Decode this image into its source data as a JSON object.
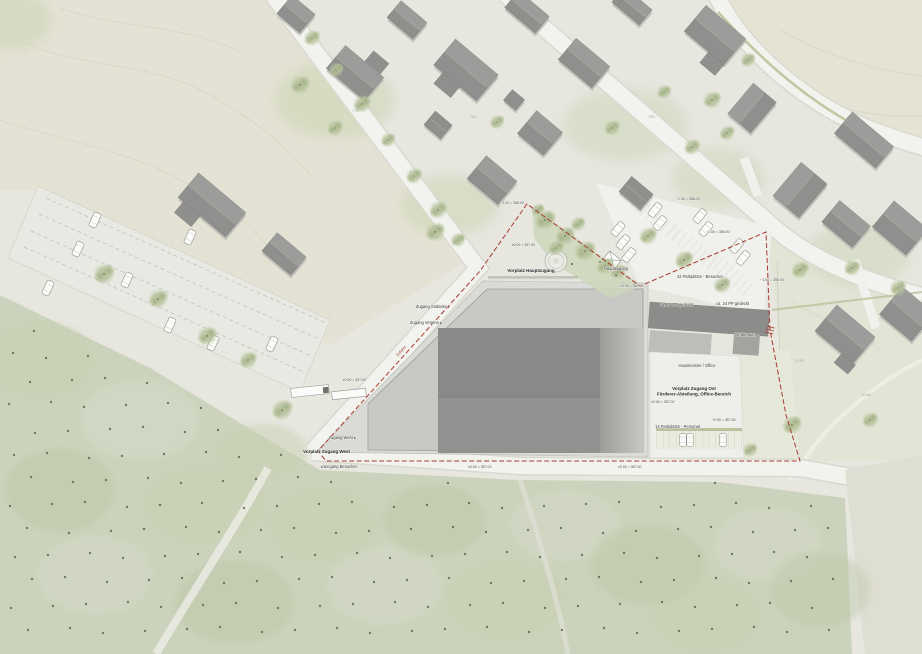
{
  "plan": {
    "labels": {
      "vorplatz_hauptzugang": "Vorplatz Hauptzugang",
      "hauptzugang": "Hauptzugang",
      "hauptzugang_arrow": "▼",
      "zugang_suedseite": "Zugang Südseite ▸",
      "zugang_vereine": "Zugang Vereine ▸",
      "zufahrt": "Zufahrt",
      "zugang_west": "Zugang West ▸",
      "vorplatz_zugang_west": "Vorplatz Zugang West",
      "eingang_besucher": "◂ Eingang Besucher",
      "vorplatz_zugang_ost_line1": "Vorplatz Zugang Ost",
      "vorplatz_zugang_ost_line2": "Förderer-Abteilung, Office-Bereich",
      "parkplaetze_besucher": "42 Parkplätze - Besucher",
      "pp_gedeckt_links": "ca. 20 PP gedeckt",
      "pp_gedeckt_rechts": "ca. 24 PP gedeckt",
      "geraeteraum": "Geräteraum",
      "hausmeister_office": "Hausmeister / Office",
      "parkplaetze_personal": "13 Parkplätze - Personal"
    },
    "elevations": [
      "−1.00 = 356.00",
      "±0.00 = 357.00",
      "±0.00 = 357.00",
      "−1.00 = 356.00",
      "−1.00 = 356.00",
      "−1.00 = 356.00",
      "±0.00 = 357.00",
      "±0.00 = 357.00",
      "+0.50 = 357.50",
      "±0.00 = 357.00",
      "±0.00 = 357.00"
    ],
    "parcel_numbers": [
      "779",
      "781",
      "783",
      "2159",
      "2156"
    ],
    "colors": {
      "boundary_red": "#a83a30",
      "building_dark": "#8d8d8a",
      "building_mid": "#c8c8c5",
      "plaza": "#dadad6",
      "road": "#f2f2ee",
      "forest": "#ccd3bc",
      "tree": "#adbb93",
      "field": "#e4e2d4",
      "text": "#3c3c3c"
    }
  }
}
